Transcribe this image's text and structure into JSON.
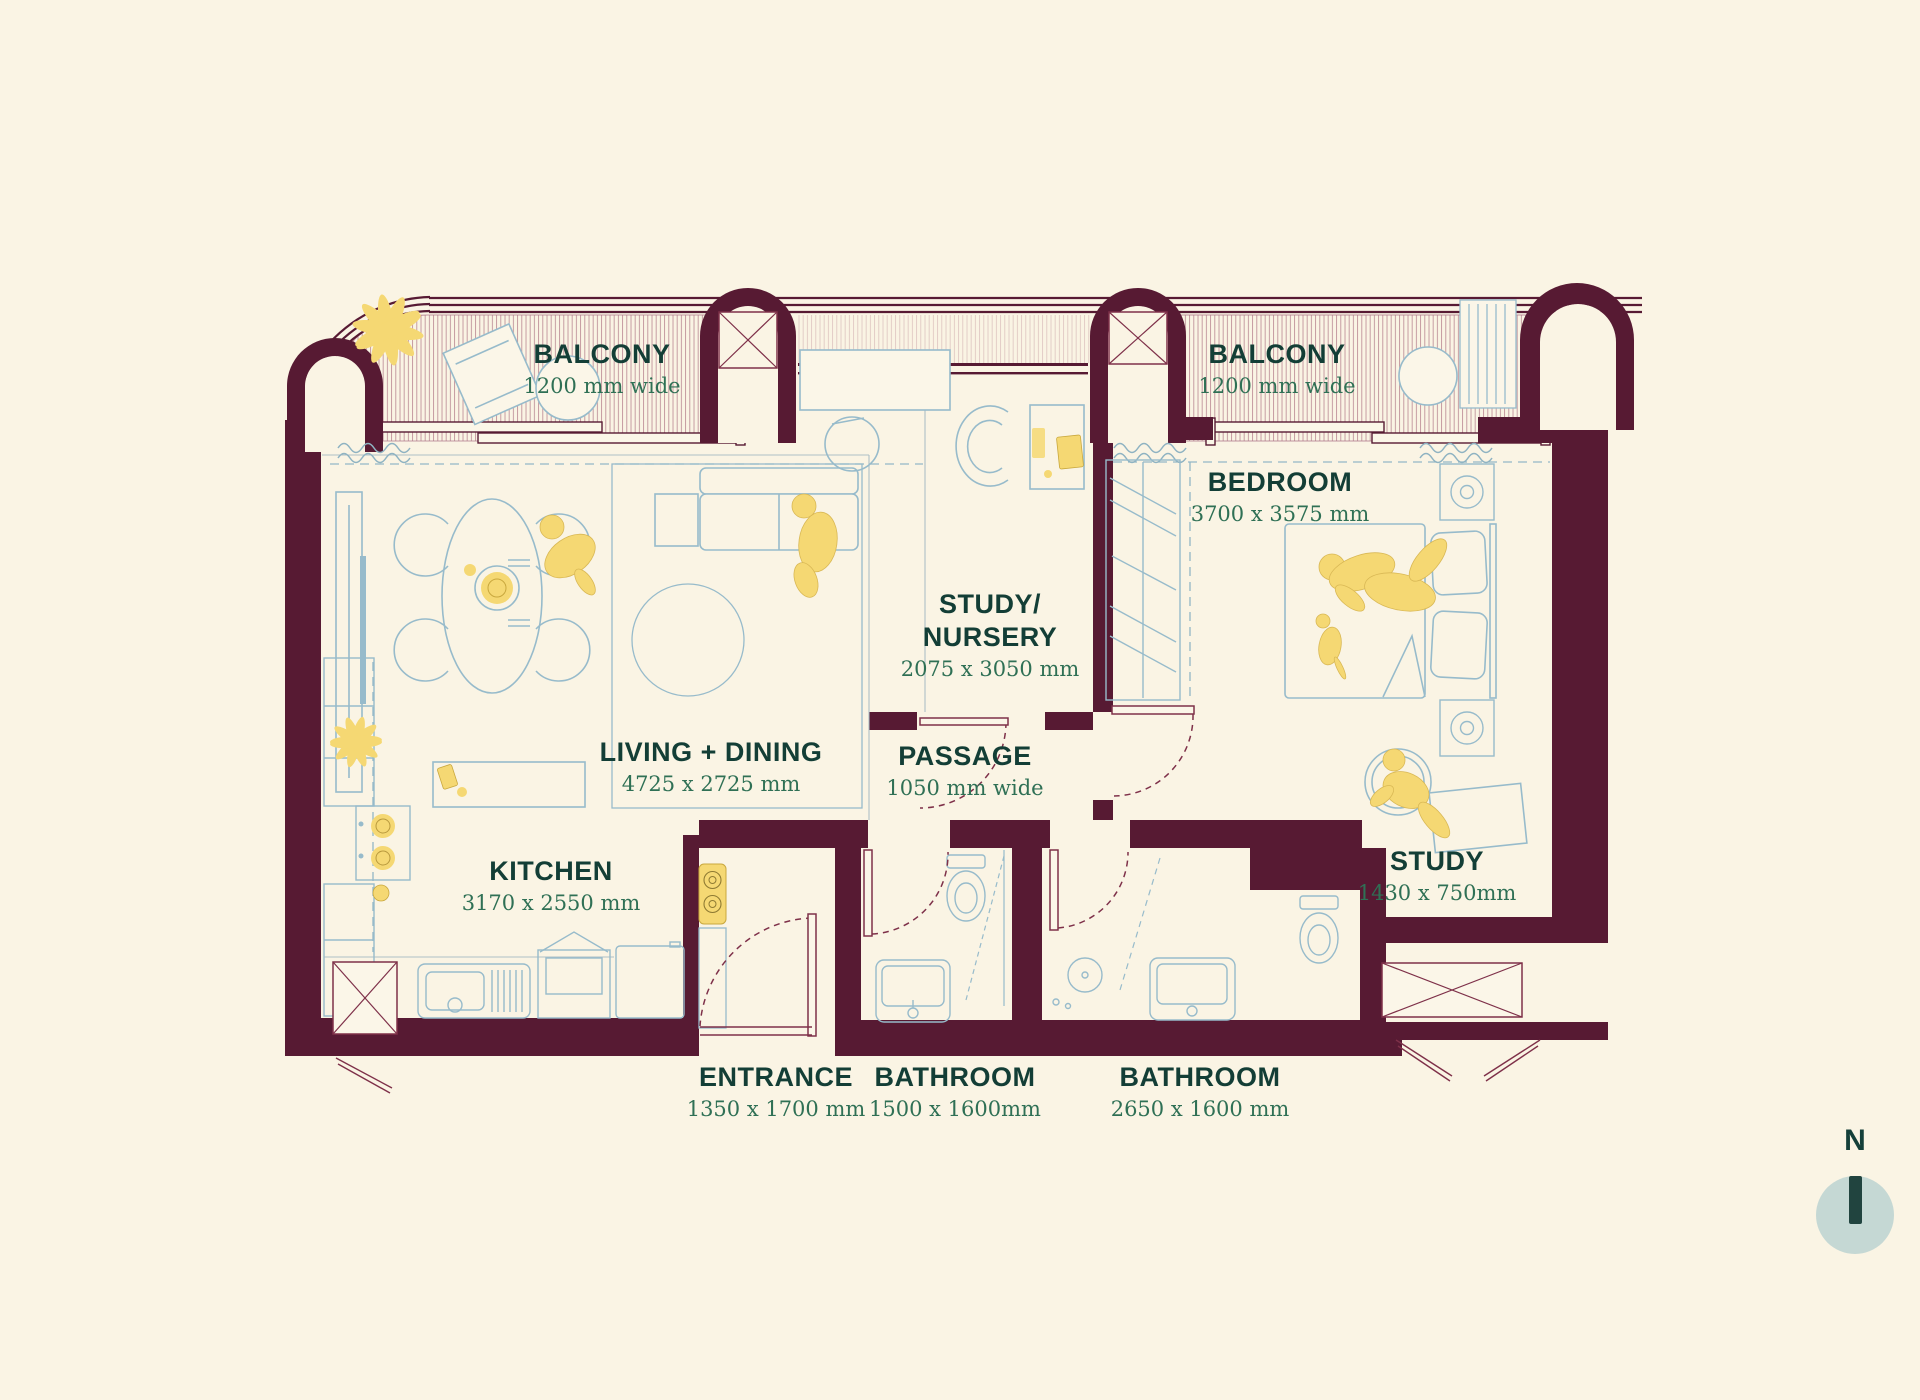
{
  "palette": {
    "wall": "#571A33",
    "door_line": "#7E3049",
    "furniture_line": "#97BBCB",
    "guide_dash": "#93B7C6",
    "accent_yellow": "#F5D873",
    "room_label_text": "#133E36",
    "dimension_text": "#2F7055",
    "background": "#FAF4E4",
    "compass_circle": "#C5D8D4",
    "compass_needle": "#21443F"
  },
  "rooms": {
    "balcony_left": {
      "name": "BALCONY",
      "dims": "1200 mm wide"
    },
    "balcony_right": {
      "name": "BALCONY",
      "dims": "1200 mm wide"
    },
    "bedroom": {
      "name": "BEDROOM",
      "dims": "3700 x 3575 mm"
    },
    "study_nursery": {
      "name_line1": "STUDY/",
      "name_line2": "NURSERY",
      "dims": "2075 x 3050 mm"
    },
    "living_dining": {
      "name": "LIVING + DINING",
      "dims": "4725 x 2725 mm"
    },
    "passage": {
      "name": "PASSAGE",
      "dims": "1050 mm wide"
    },
    "kitchen": {
      "name": "KITCHEN",
      "dims": "3170 x 2550 mm"
    },
    "study": {
      "name": "STUDY",
      "dims": "1430 x 750mm"
    },
    "entrance": {
      "name": "ENTRANCE",
      "dims": "1350 x 1700 mm"
    },
    "bathroom_1": {
      "name": "BATHROOM",
      "dims": "1500 x 1600mm"
    },
    "bathroom_2": {
      "name": "BATHROOM",
      "dims": "2650 x 1600 mm"
    }
  },
  "compass": {
    "label": "N"
  }
}
